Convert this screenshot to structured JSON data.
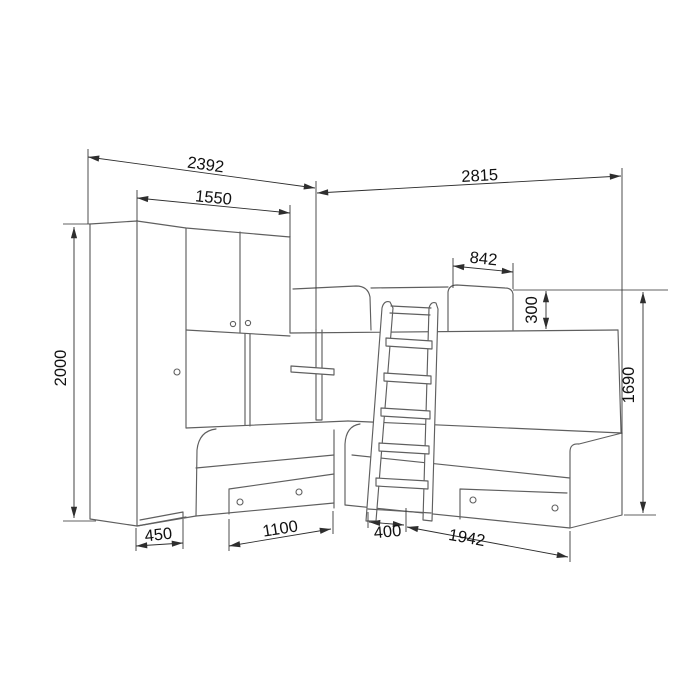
{
  "drawing": {
    "kind": "furniture dimension line drawing",
    "subject": "corner bunk bed set with wardrobe, overhead cabinets, wall shelf, ladder and two lower beds with drawers",
    "background_color": "#ffffff",
    "line_color": "#5f5f5f",
    "dimension_line_color": "#2e2e2e",
    "text_color": "#111111"
  },
  "dimensions": {
    "left_section_width": "2392",
    "cabinets_width": "1550",
    "right_section_width": "2815",
    "headboard_width": "842",
    "headboard_height": "300",
    "wardrobe_height": "2000",
    "bunk_height": "1690",
    "wardrobe_depth": "450",
    "left_bed_length": "1100",
    "ladder_width": "400",
    "right_bed_length": "1942"
  }
}
